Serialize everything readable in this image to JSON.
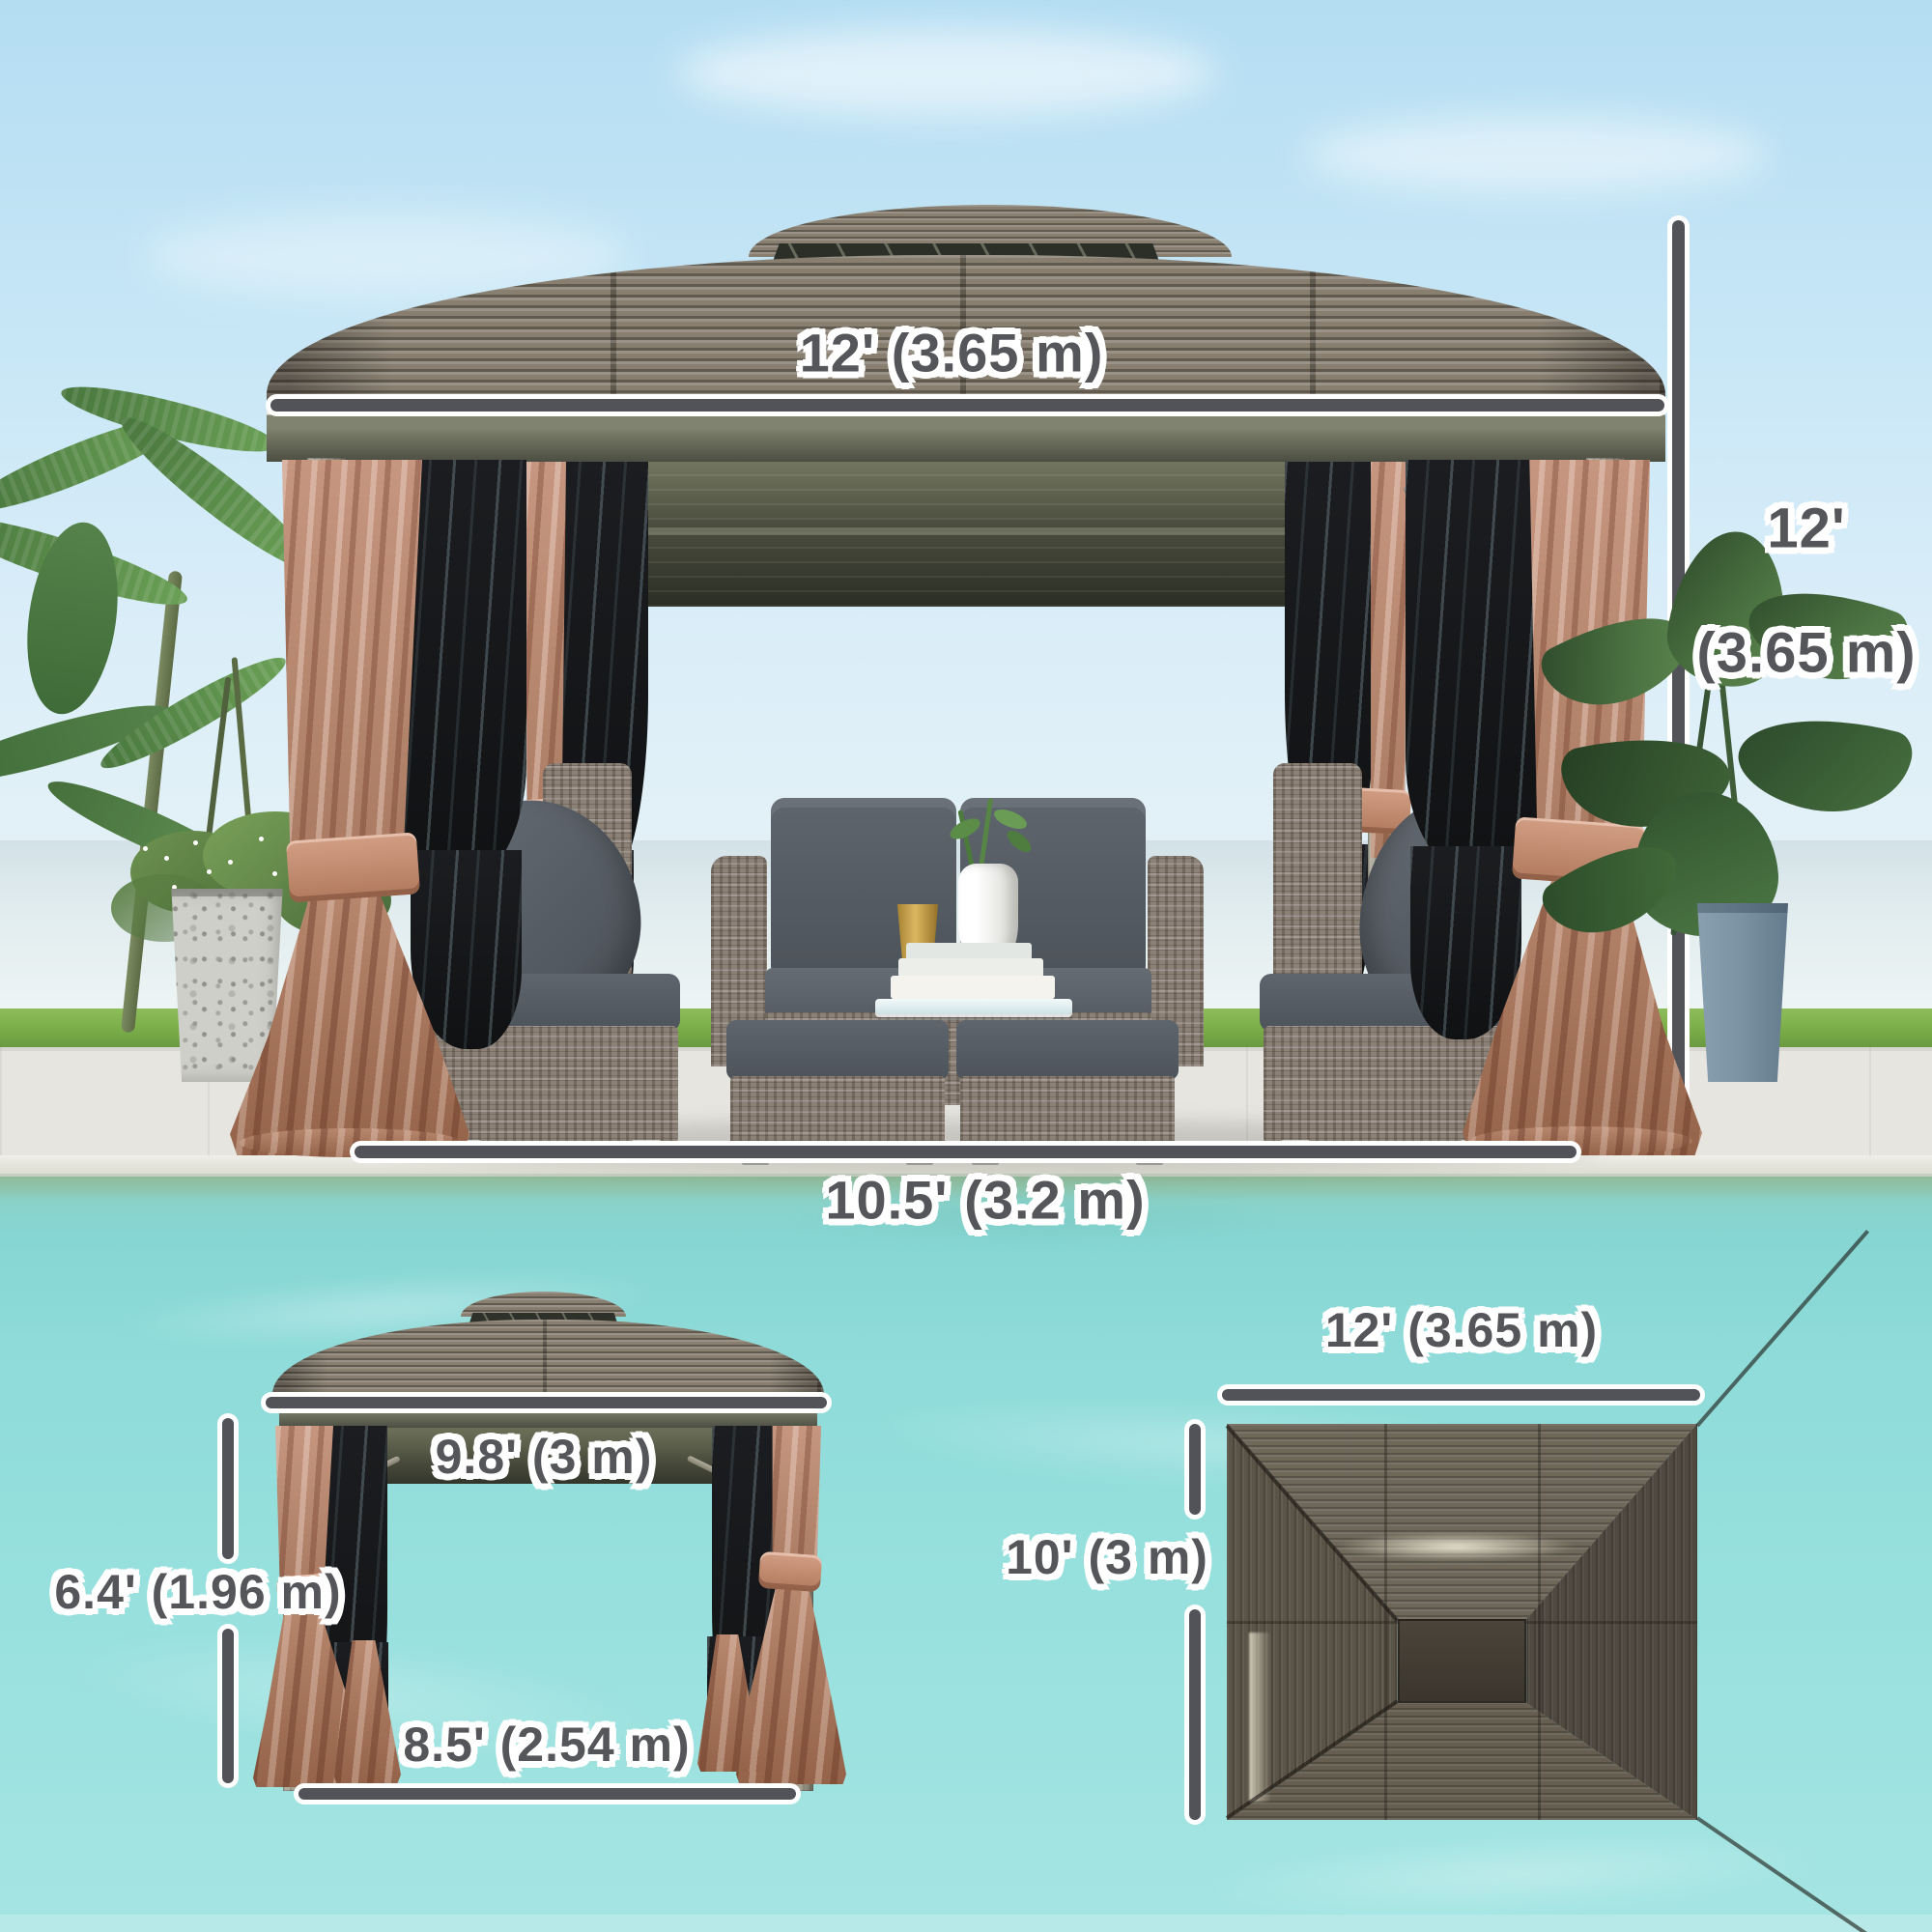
{
  "title": "Hardtop Gazebo Dimension Infographic",
  "colors": {
    "dimension_line": "#515358",
    "dimension_text": "#54565a",
    "text_halo": "#ffffff",
    "roof_metal": "#887f71",
    "curtain_tan": "#b9886f",
    "mesh_black": "#16181b",
    "cushion_gray": "#565c64",
    "pool_water": "#8edbd9",
    "grass_green": "#79ac48",
    "patio_stone": "#e7e5e0",
    "sky_blue": "#c6e6f6",
    "planter_blue": "#7e95a6"
  },
  "views": {
    "main_front": {
      "roof_width_label": "12' (3.65 m)",
      "height_label_line1": "12'",
      "height_label_line2": "(3.65 m)",
      "footprint_width_label": "10.5' (3.2 m)"
    },
    "side_view": {
      "roof_depth_label": "9.8' (3 m)",
      "clearance_height_label": "6.4' (1.96 m)",
      "footprint_depth_label": "8.5' (2.54 m)"
    },
    "top_view": {
      "roof_width_label": "12' (3.65 m)",
      "roof_depth_label": "10' (3 m)"
    }
  }
}
